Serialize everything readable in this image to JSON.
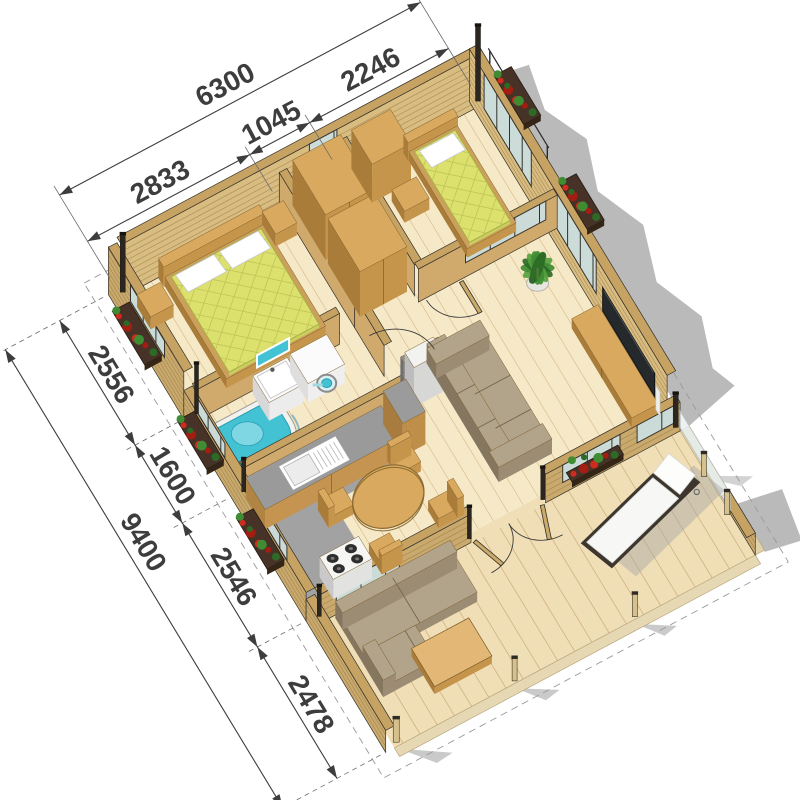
{
  "figure": {
    "kind": "3d-floor-plan-render",
    "units": "mm"
  },
  "dims": {
    "top": {
      "overall": {
        "label": "6300",
        "value": 6300
      },
      "segments": [
        {
          "label": "2833",
          "value": 2833
        },
        {
          "label": "1045",
          "value": 1045
        },
        {
          "label": "2246",
          "value": 2246
        }
      ]
    },
    "left": {
      "overall": {
        "label": "9400",
        "value": 9400
      },
      "segments": [
        {
          "label": "2556",
          "value": 2556
        },
        {
          "label": "1600",
          "value": 1600
        },
        {
          "label": "2546",
          "value": 2546
        },
        {
          "label": "2478",
          "value": 2478
        }
      ]
    }
  },
  "palette": {
    "floor": "#f6e9c8",
    "plank": "#dabf8e",
    "deck": "#f0dfb6",
    "deckPlank": "#cfb183",
    "fascia": "#e6d8b2",
    "wallTop": "#c6a263",
    "wallFace": "#d9bc80",
    "wallFaceOuter": "#c9a96c",
    "stripe": "#8a6f42",
    "cut": "#2c2722",
    "frame": "#33302a",
    "glass": "#ccdede",
    "grayFloor": "#a2a2a2",
    "woodTop": "#d9a95f",
    "woodSide": "#aa7c3a",
    "woodFront": "#c6954c",
    "woodLine": "#7d5e2b",
    "mattress": "#dce06d",
    "quilt": "#bfc457",
    "mattressEdge": "#cbcf5d",
    "sofaTop": "#b2a48a",
    "sofaFront": "#9b8c73",
    "sofaSide": "#857660",
    "sofaLine": "#74654f",
    "teal": "#43c2d4",
    "tealDark": "#2a9db2",
    "counter": "#9a9a9a",
    "shadow": "#a7a7a7",
    "leaf": "#3f8c33",
    "leafDark": "#2c6a26",
    "flower": "#cf2b1e",
    "flowerDark": "#a31d12",
    "plantBox": "#463226",
    "post": "#d6c08c",
    "cap": "#2e2a24",
    "tv": "#26292c",
    "white": "#ffffff",
    "dim": "#3d3d3d"
  }
}
